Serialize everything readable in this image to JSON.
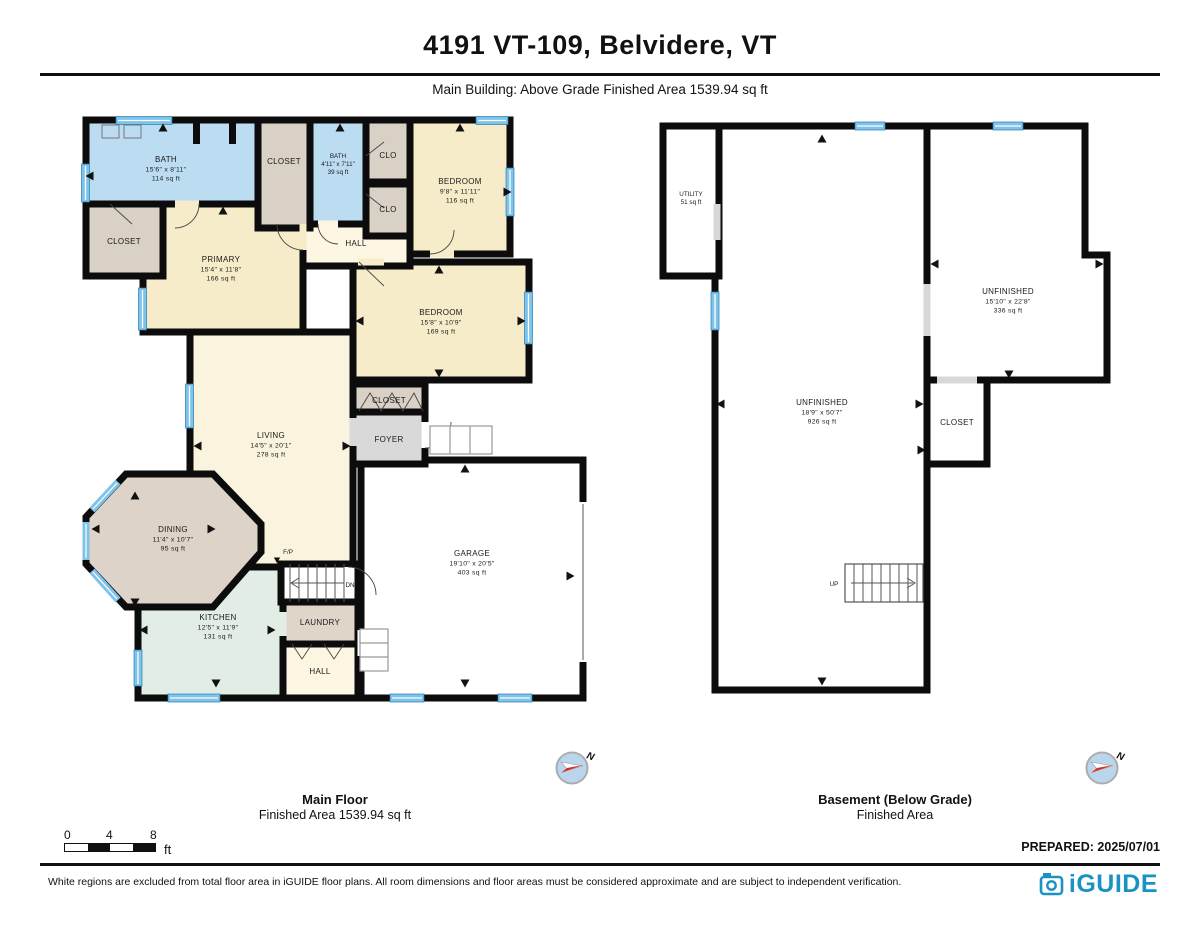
{
  "header": {
    "title": "4191 VT-109, Belvidere, VT",
    "subtitle": "Main Building: Above Grade Finished Area 1539.94 sq ft"
  },
  "main_floor": {
    "caption": {
      "title": "Main Floor",
      "subtitle": "Finished Area 1539.94 sq ft"
    },
    "rooms": {
      "bath_primary": {
        "name": "BATH",
        "dims": "15'6\" x 8'11\"",
        "area": "114 sq ft"
      },
      "closet_primary": {
        "name": "CLOSET"
      },
      "closet_hall": {
        "name": "CLOSET"
      },
      "bath_hall": {
        "name": "BATH",
        "dims": "4'11\" x 7'11\"",
        "area": "39 sq ft"
      },
      "clo_1": {
        "name": "CLO"
      },
      "clo_2": {
        "name": "CLO"
      },
      "bedroom_front": {
        "name": "BEDROOM",
        "dims": "9'8\" x 11'11\"",
        "area": "116 sq ft"
      },
      "primary": {
        "name": "PRIMARY",
        "dims": "15'4\" x 11'8\"",
        "area": "166 sq ft"
      },
      "hall_upper": {
        "name": "HALL"
      },
      "bedroom_side": {
        "name": "BEDROOM",
        "dims": "15'8\" x 10'9\"",
        "area": "169 sq ft"
      },
      "closet_foyer": {
        "name": "CLOSET"
      },
      "foyer": {
        "name": "FOYER"
      },
      "living": {
        "name": "LIVING",
        "dims": "14'5\" x 20'1\"",
        "area": "278 sq ft"
      },
      "dining": {
        "name": "DINING",
        "dims": "11'4\" x 10'7\"",
        "area": "95 sq ft"
      },
      "kitchen": {
        "name": "KITCHEN",
        "dims": "12'5\" x 11'9\"",
        "area": "131 sq ft"
      },
      "laundry": {
        "name": "LAUNDRY"
      },
      "hall_lower": {
        "name": "HALL"
      },
      "garage": {
        "name": "GARAGE",
        "dims": "19'10\" x 20'5\"",
        "area": "403 sq ft"
      },
      "fireplace": {
        "name": "F/P"
      },
      "stairs_dn": {
        "name": "DN"
      }
    }
  },
  "basement": {
    "caption": {
      "title": "Basement (Below Grade)",
      "subtitle": "Finished Area"
    },
    "rooms": {
      "utility": {
        "name": "UTILITY",
        "area": "51 sq ft"
      },
      "unfinished_main": {
        "name": "UNFINISHED",
        "dims": "18'9\" x 50'7\"",
        "area": "926 sq ft"
      },
      "unfinished_side": {
        "name": "UNFINISHED",
        "dims": "15'10\" x 22'8\"",
        "area": "336 sq ft"
      },
      "closet": {
        "name": "CLOSET"
      },
      "stairs_up": {
        "name": "UP"
      }
    }
  },
  "scale_bar": {
    "tick_0": "0",
    "tick_4": "4",
    "tick_8": "8",
    "unit": "ft"
  },
  "compass": {
    "north_label": "N"
  },
  "prepared_label": "PREPARED: 2025/07/01",
  "footer": {
    "disclaimer": "White regions are excluded from total floor area in iGUIDE floor plans. All room dimensions and floor areas must be considered approximate and are subject to independent verification.",
    "brand": "iGUIDE"
  },
  "colors": {
    "wet_room_blue": "#bcdcf2",
    "bedroom_cream": "#f6ecc9",
    "hall_cream": "#fdf6e3",
    "living_cream": "#faf3dd",
    "closet_tan": "#d9d0c6",
    "kitchen_green": "#e2eee5",
    "foyer_gray": "#d9d9d9",
    "window_blue": "#7ec3ea",
    "brand_blue": "#1a93c4",
    "wall_black": "#0c0c0c"
  }
}
